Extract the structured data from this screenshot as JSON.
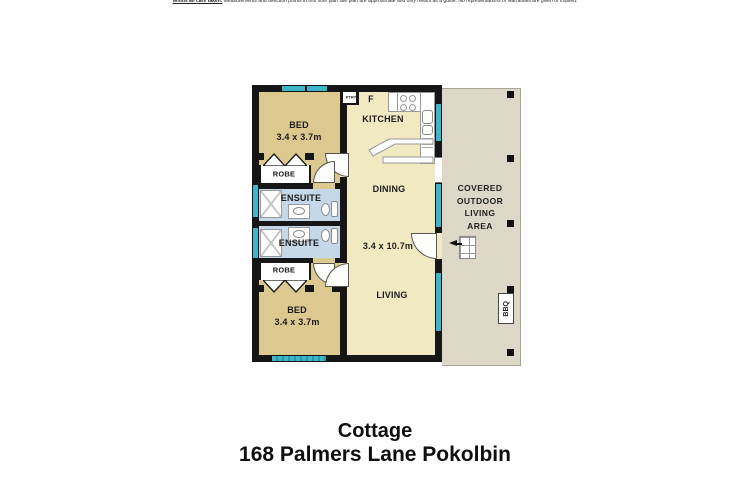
{
  "disclaimer": {
    "lead": "Whilst all care taken:",
    "body": " Measurements and direction points in this floor plan site plan are approximate and only meant as a guide. No representations or warranties are given or implied."
  },
  "plan": {
    "bed1": {
      "name": "BED",
      "size": "3.4 x 3.7m"
    },
    "bed2": {
      "name": "BED",
      "size": "3.4 x 3.7m"
    },
    "kitchen": "KITCHEN",
    "dining": "DINING",
    "living": "LIVING",
    "open_size": "3.4 x 10.7m",
    "ensuite1": "ENSUITE",
    "ensuite2": "ENSUITE",
    "robe1": "ROBE",
    "robe2": "ROBE",
    "pantry": "PTRY",
    "fridge": "F",
    "outdoor": {
      "l1": "COVERED",
      "l2": "OUTDOOR",
      "l3": "LIVING",
      "l4": "AREA"
    },
    "bbq": "BBQ"
  },
  "title": {
    "name": "Cottage",
    "address": "168 Palmers Lane Pokolbin"
  },
  "colors": {
    "wall": "#161616",
    "bedroom_floor": "#dcc990",
    "living_floor": "#f1e9c2",
    "ensuite_floor": "#c5d8e9",
    "outdoor_floor": "#dcd7c7",
    "window": "#3eb5c8"
  }
}
